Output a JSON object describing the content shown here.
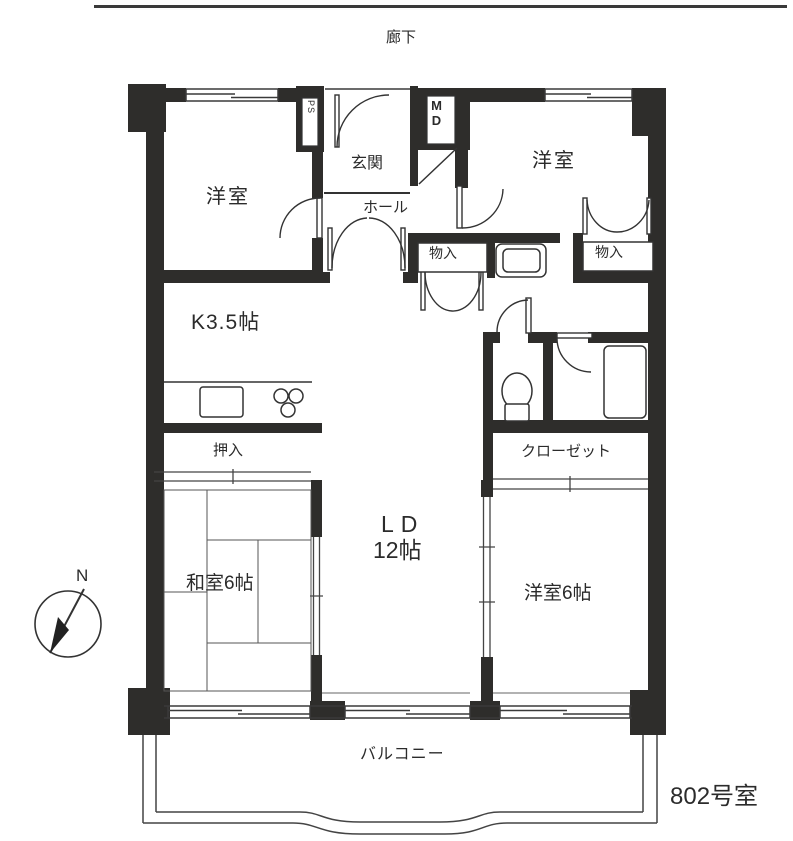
{
  "document": {
    "type": "apartment-floor-plan",
    "unit_number": "802号室"
  },
  "labels": {
    "corridor": "廊下",
    "room_top_left": "洋室",
    "room_top_right": "洋室",
    "entrance": "玄関",
    "hall": "ホール",
    "pipe_space": "PS",
    "meter_box": "MD",
    "storage_left": "物入",
    "storage_right": "物入",
    "kitchen": "K3.5帖",
    "oshiire": "押入",
    "closet": "クローゼット",
    "living_dining": "LD",
    "living_dining_size": "12帖",
    "japanese_room": "和室6帖",
    "western_room": "洋室6帖",
    "balcony": "バルコニー",
    "unit_number": "802号室",
    "compass_north": "N"
  },
  "icons": {
    "toilet": "toilet-icon",
    "bathtub": "bathtub-icon",
    "sink": "kitchen-sink-icon",
    "stove": "gas-stove-icon",
    "washer": "washing-machine-pan-icon",
    "compass": "compass-north-icon"
  },
  "colors": {
    "wall": "#2e2d2b",
    "line": "#3a3a3a",
    "thin_line": "#555555",
    "background": "#ffffff",
    "text": "#2b2b2b"
  }
}
